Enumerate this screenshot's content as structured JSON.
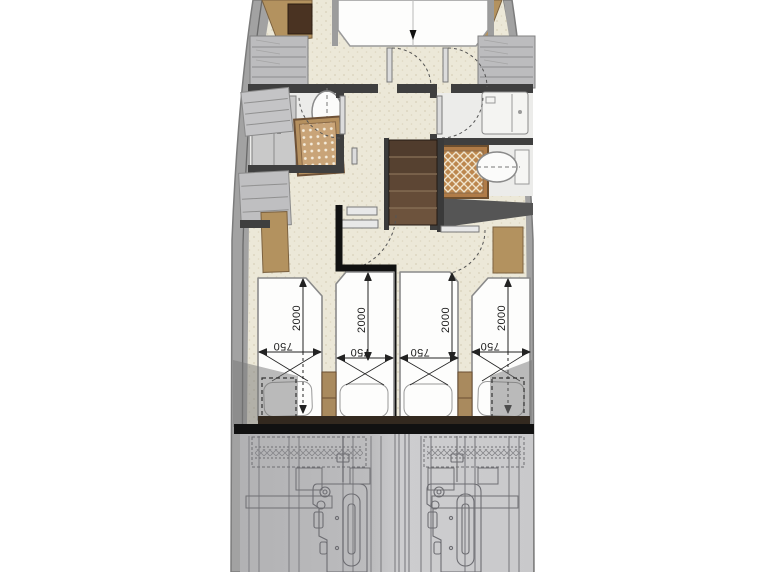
{
  "plan": {
    "type": "yacht-lower-deck-floor-plan",
    "colors": {
      "floor_beige": "#ece8d8",
      "stipple": "#d8d1b9",
      "hull_gray": "#a2a2a2",
      "wall_dark": "#3f3f3f",
      "wood_tan": "#b3925f",
      "wood_dark": "#4a3322",
      "stairs_brown": "#56412f",
      "bathroom_floor": "#ececea",
      "engine_room_gray": "#c2c2c4",
      "engine_line": "#6d6d72",
      "separator_black": "#111111"
    },
    "bow_cabin": {
      "name": "forward-cabin",
      "bed": "double-bed",
      "wardrobes": 2,
      "shelf_units": 2
    },
    "port_bathroom": {
      "name": "port-bathroom",
      "fixtures": [
        "toilet",
        "shower-grate",
        "cabinet"
      ]
    },
    "starboard_bathroom": {
      "name": "starboard-bathroom",
      "fixtures": [
        "sink",
        "shower-grate",
        "toilet"
      ]
    },
    "staircase": {
      "name": "companionway-stairs",
      "treads": 5
    },
    "aft_cabins": {
      "name": "twin-guest-cabins",
      "beds": [
        {
          "name": "port-outboard-bed",
          "length_label": "2000",
          "width_label": "750"
        },
        {
          "name": "port-inboard-bed",
          "length_label": "2000",
          "width_label": "750"
        },
        {
          "name": "starboard-inboard-bed",
          "length_label": "2000",
          "width_label": "750"
        },
        {
          "name": "starboard-outboard-bed",
          "length_label": "2000",
          "width_label": "750"
        }
      ]
    },
    "engine_room": {
      "name": "engine-room",
      "engines": 2
    }
  }
}
